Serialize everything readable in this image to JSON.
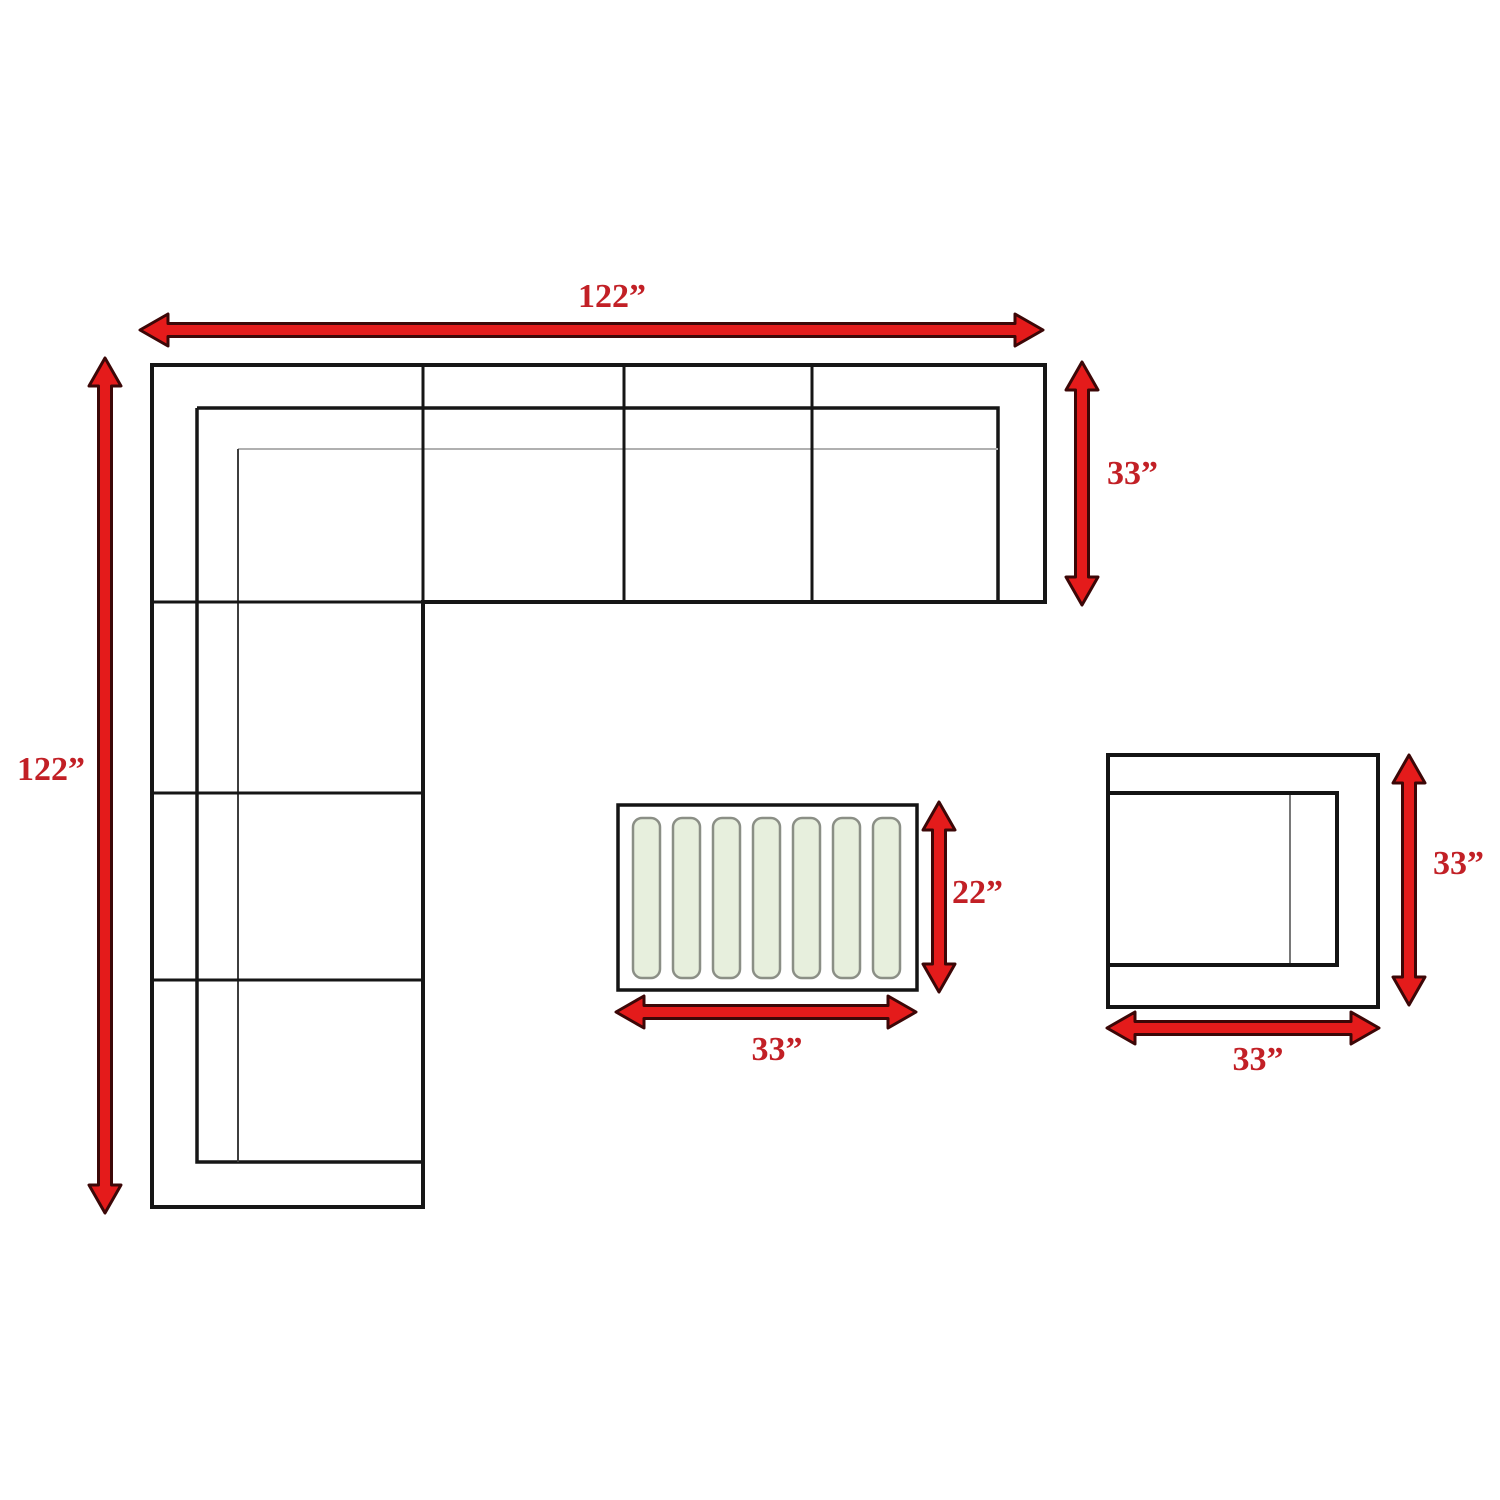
{
  "diagram": {
    "type": "furniture-dimension-plan",
    "components": [
      {
        "name": "sectional-sofa",
        "shape": "L-shaped sectional, top-down view",
        "width": "122”",
        "depth_total": "122”",
        "section_depth": "33”"
      },
      {
        "name": "coffee-table",
        "shape": "rectangular slatted table, top-down view",
        "width": "33”",
        "depth": "22”",
        "slat_count": 7
      },
      {
        "name": "corner-chair",
        "shape": "square club chair, top-down view",
        "width": "33”",
        "depth": "33”"
      }
    ]
  },
  "labels": {
    "sofa_width": "122”",
    "sofa_height": "122”",
    "sofa_depth": "33”",
    "table_depth": "22”",
    "table_width": "33”",
    "chair_depth": "33”",
    "chair_width": "33”"
  },
  "colors": {
    "arrow_fill": "#e41b1b",
    "arrow_outline": "#3c0707",
    "label_text": "#c22026",
    "line_black": "#161616",
    "cushion_line_gray": "#b0b0b0",
    "slat_fill": "#e7efdd",
    "slat_border": "#8b8f86",
    "background": "#ffffff"
  }
}
